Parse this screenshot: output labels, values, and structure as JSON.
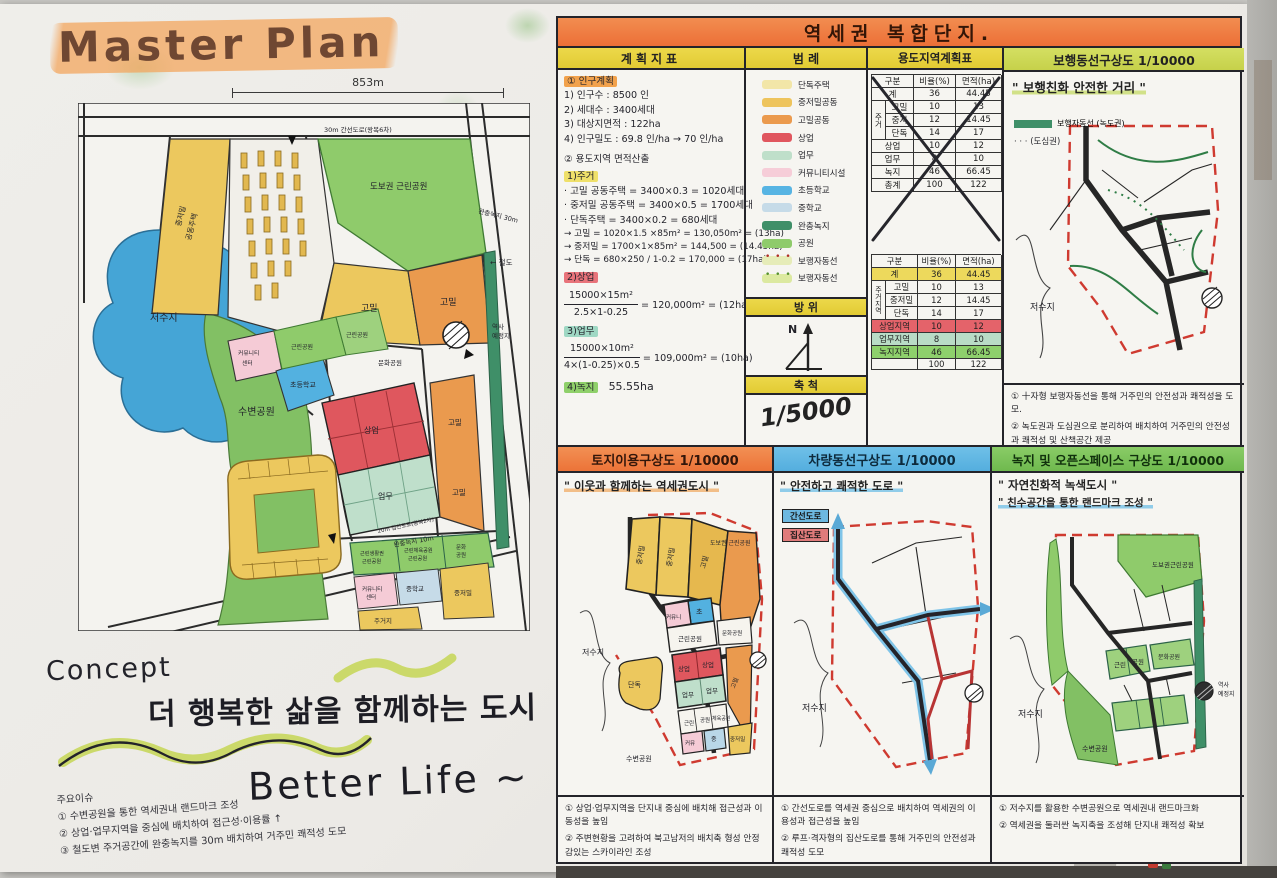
{
  "colors": {
    "banner_orange": "#ec6f37",
    "header_yellow": "#e2cb33",
    "header_yellowgreen": "#ccd755",
    "header_blue": "#5fb7e3",
    "header_green": "#7dc35c",
    "park_green": "#8fcb6b",
    "buffer_green": "#3f8f68",
    "lake_blue": "#45a5d6",
    "commercial_red": "#df575e",
    "business_teal": "#bfdfcb",
    "residential_yellow": "#ecc85e",
    "highdensity_orange": "#ea9a4e",
    "community_pink": "#f5cbd6",
    "school_blue": "#53b1e0",
    "midschool_blue": "#c6dbe8",
    "boundary_red": "#cf3a30"
  },
  "title": "Master Plan",
  "main_map": {
    "dim_top": "853m",
    "dim_right": "1439M",
    "road_top": "30m 간선도로(왕복6차)",
    "road_mid": "20m 집산도로(왕복2차)",
    "labels": {
      "lake": "저수지",
      "waterpark": "수변공원",
      "walkpark": "도보권 근린공원",
      "left_res1": "중저밀",
      "left_res2": "공동주택",
      "highd1": "고밀",
      "highd2": "고밀",
      "highd3": "고밀",
      "highd4": "고밀",
      "npark1": "근린공원",
      "npark2": "근린공원",
      "culture_mid": "문화공원",
      "elem": "초등학교",
      "comm1a": "커뮤니티",
      "comm1b": "센터",
      "sang": "상업",
      "biz": "업무",
      "parkrow1a": "근린생활권",
      "parkrow1b": "근린공원",
      "parkrow2a": "근린체육공원",
      "parkrow2b": "근린공원",
      "parkrow3a": "문화",
      "parkrow3b": "공원",
      "comm2a": "커뮤니티",
      "comm2b": "센터",
      "mids": "중학교",
      "res_r": "중저밀",
      "res_b": "주거지",
      "station_a": "역사",
      "station_b": "예정지",
      "rail": "← 철도",
      "buffer30": "완충녹지 30m",
      "buffer10": "완충녹지 10m"
    }
  },
  "concept": {
    "heading": "Concept",
    "phrase": "더  행복한  삶을  함께하는  도시",
    "tagline": "Better  Life ~",
    "issues_title": "주요이슈",
    "issues": [
      "① 수변공원을 통한 역세권내 랜드마크 조성",
      "② 상업·업무지역을 중심에 배치하여 접근성·이용률 ↑",
      "③ 철도변 주거공간에 완충녹지를 30m 배치하여 거주민 쾌적성 도모"
    ]
  },
  "right": {
    "banner": "역세권  복합단지.",
    "plan": {
      "header": "계획지표",
      "sec1": "① 인구계획",
      "l1": "1) 인구수 : 8500 인",
      "l2": "2) 세대수 : 3400세대",
      "l3": "3) 대상지면적 : 122ha",
      "l4": "4) 인구밀도 : 69.8 인/ha → 70 인/ha",
      "sec2": "② 용도지역  면적산출",
      "sub1": "1)주거",
      "r1": "· 고밀 공동주택 = 3400×0.3 = 1020세대",
      "r2": "· 중저밀 공동주택 = 3400×0.5 = 1700세대",
      "r3": "· 단독주택 = 3400×0.2 = 680세대",
      "r4": "→ 고밀 = 1020×1.5 ×85m² = 130,050m² = (13ha)",
      "r5": "→ 중저밀 = 1700×1×85m² = 144,500 = (14.45ha)",
      "r6": "→ 단독 = 680×250 / 1-0.2 = 170,000 = (17ha)",
      "sub2": "2)상업",
      "f1n": "15000×15m²",
      "f1d": "2.5×1-0.25",
      "f1r": "= 120,000m² = (12ha)",
      "sub3": "3)업무",
      "f2n": "15000×10m²",
      "f2d": "4×(1-0.25)×0.5",
      "f2r": "= 109,000m² = (10ha)",
      "sub4": "4)녹지",
      "green_total": "55.55ha"
    },
    "legend": {
      "header": "범  례",
      "items": [
        {
          "label": "단독주택",
          "color": "#f2e6a8"
        },
        {
          "label": "중저밀공동",
          "color": "#eec45c"
        },
        {
          "label": "고밀공동",
          "color": "#eb9a4d"
        },
        {
          "label": "상업",
          "color": "#e0565e"
        },
        {
          "label": "업무",
          "color": "#bfdfca"
        },
        {
          "label": "커뮤니티시설",
          "color": "#f6cdd8"
        },
        {
          "label": "초등학교",
          "color": "#57b4e3"
        },
        {
          "label": "중학교",
          "color": "#c6dbe8"
        },
        {
          "label": "완충녹지",
          "color": "#3f8f68"
        },
        {
          "label": "공원",
          "color": "#8fcb6b"
        },
        {
          "label": "보행자동선",
          "color": "#e6ecb8"
        },
        {
          "label": "보행자동선",
          "color": "#dce9a0"
        }
      ]
    },
    "compass": {
      "header": "방  위",
      "n": "N"
    },
    "scale": {
      "header": "축  척",
      "value": "1/5000"
    },
    "table": {
      "header": "용도지역계획표",
      "col_label": "구분",
      "col_ratio": "비율(%)",
      "col_area": "면적(ha)",
      "res_group": "주거지역",
      "res_group_short": "주거",
      "crossed": {
        "rows": [
          {
            "g": "",
            "l": "계",
            "r": "36",
            "a": "44.45"
          },
          {
            "g": "주거",
            "l": "고밀",
            "r": "10",
            "a": "13"
          },
          {
            "g": "",
            "l": "중저",
            "r": "12",
            "a": "14.45"
          },
          {
            "g": "",
            "l": "단독",
            "r": "14",
            "a": "17"
          },
          {
            "g": "",
            "l": "상업",
            "r": "10",
            "a": "12"
          },
          {
            "g": "",
            "l": "업무",
            "r": "8",
            "a": "10"
          },
          {
            "g": "",
            "l": "녹지",
            "r": "46",
            "a": "66.45"
          },
          {
            "g": "",
            "l": "총계",
            "r": "100",
            "a": "122"
          }
        ]
      },
      "fixed": {
        "rows": [
          {
            "l": "계",
            "r": "36",
            "a": "44.45",
            "bg": "#edd95c"
          },
          {
            "l": "고밀",
            "r": "10",
            "a": "13",
            "bg": ""
          },
          {
            "l": "중저밀",
            "r": "12",
            "a": "14.45",
            "bg": ""
          },
          {
            "l": "단독",
            "r": "14",
            "a": "17",
            "bg": ""
          },
          {
            "l": "상업지역",
            "r": "10",
            "a": "12",
            "bg": "#e4636a"
          },
          {
            "l": "업무지역",
            "r": "8",
            "a": "10",
            "bg": "#b9dcc6"
          },
          {
            "l": "녹지지역",
            "r": "46",
            "a": "66.45",
            "bg": "#8ed06c"
          },
          {
            "l": "",
            "r": "100",
            "a": "122",
            "bg": ""
          }
        ]
      }
    },
    "ped": {
      "header": "보행동선구상도 1/10000",
      "quote": "\" 보행친화  안전한  거리 \"",
      "leg1": "보행자동선 (녹도권)",
      "leg2": "· · ·  (도심권)",
      "lake": "저수지",
      "note1": "① 十자형 보행자동선을 통해 거주민의 안전성과 쾌적성을 도모.",
      "note2": "② 녹도권과 도심권으로 분리하여 배치하여 거주민의 안전성과 쾌적성 및 산책공간 제공"
    },
    "landuse": {
      "header": "토지이용구상도 1/10000",
      "quote": "\" 이웃과  함께하는  역세권도시 \"",
      "labels": {
        "p1": "중저밀",
        "p2": "중저밀",
        "p3": "고밀",
        "walkpark": "도보권 근린공원",
        "culture": "문화공원",
        "elem": "초",
        "comm": "커뮤니",
        "npark": "근린공원",
        "s1": "상업",
        "s2": "상업",
        "b1": "업무",
        "b2": "업무",
        "highd": "고밀",
        "row1": "근린",
        "row2": "공원",
        "row3": "체육공원",
        "comm2": "커뮤",
        "mid": "중",
        "res": "중저밀",
        "single": "단독",
        "lake": "저수지",
        "waterpark": "수변공원"
      },
      "note1": "① 상업·업무지역을 단지내 중심에 배치해 접근성과 이동성을 높임",
      "note2": "② 주변현황을 고려하여 북고남저의 배치축 형성 안정감있는 스카이라인 조성"
    },
    "traffic": {
      "header": "차량동선구상도 1/10000",
      "quote": "\" 안전하고  쾌적한  도로 \"",
      "leg1": "간선도로",
      "leg2": "집산도로",
      "lake": "저수지",
      "note1": "① 간선도로를 역세권 중심으로 배치하여 역세권의 이용성과 접근성을 높임",
      "note2": "② 루프·격자형의 집산도로를 통해 거주민의 안전성과 쾌적성 도모"
    },
    "green": {
      "header": "녹지 및 오픈스페이스 구상도 1/10000",
      "quote1": "\" 자연친화적  녹색도시 \"",
      "quote2": "\" 친수공간을 통한  랜드마크 조성 \"",
      "labels": {
        "walkpark": "도보권근린공원",
        "n1": "근린",
        "n2": "공원",
        "culture": "문화공원",
        "waterpark": "수변공원",
        "lake": "저수지",
        "st1": "역사",
        "st2": "예정지"
      },
      "note1": "① 저수지를 활용한 수변공원으로 역세권내 랜드마크화",
      "note2": "② 역세권을 둘러싼 녹지축을 조성해 단지내 쾌적성 확보"
    }
  }
}
